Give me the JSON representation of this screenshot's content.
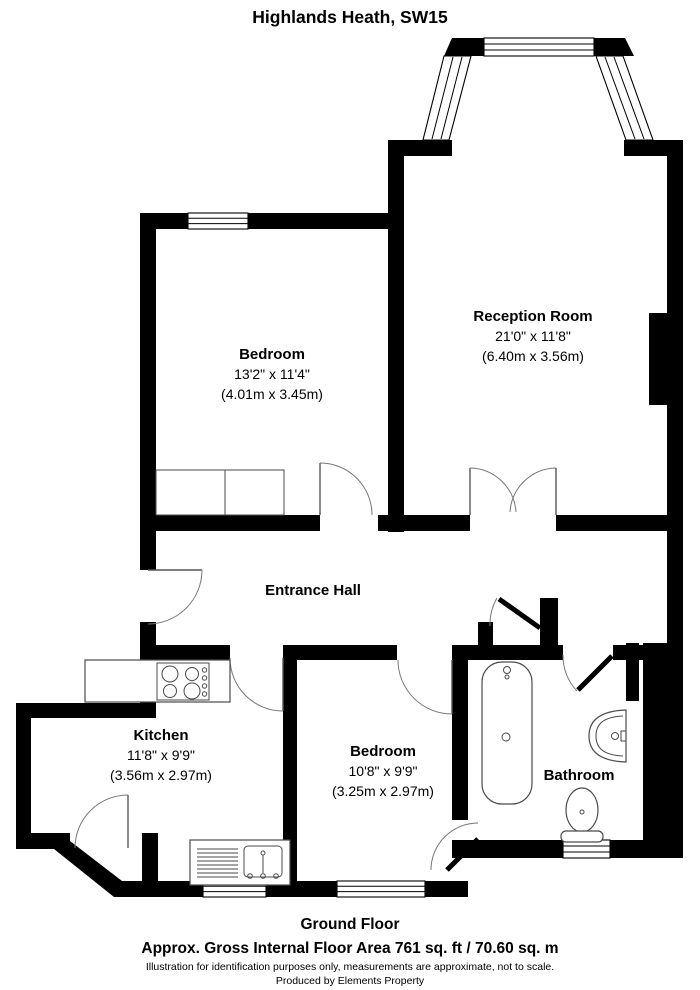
{
  "title": "Highlands Heath, SW15",
  "rooms": {
    "reception": {
      "name": "Reception Room",
      "dims_imperial": "21'0\" x 11'8\"",
      "dims_metric": "(6.40m x 3.56m)"
    },
    "bedroom1": {
      "name": "Bedroom",
      "dims_imperial": "13'2\" x 11'4\"",
      "dims_metric": "(4.01m x 3.45m)"
    },
    "entrance_hall": {
      "name": "Entrance Hall"
    },
    "kitchen": {
      "name": "Kitchen",
      "dims_imperial": "11'8\" x 9'9\"",
      "dims_metric": "(3.56m x 2.97m)"
    },
    "bedroom2": {
      "name": "Bedroom",
      "dims_imperial": "10'8\" x 9'9\"",
      "dims_metric": "(3.25m x 2.97m)"
    },
    "bathroom": {
      "name": "Bathroom"
    }
  },
  "fixtures": {
    "hob": "cooker-hob-4-rings",
    "sink": "kitchen-sink-with-drainer",
    "bath": "bathtub",
    "basin": "wash-basin",
    "toilet": "toilet"
  },
  "footer": {
    "floor_label": "Ground Floor",
    "area_line": "Approx. Gross Internal Floor Area 761 sq. ft / 70.60 sq. m",
    "disclaimer": "Illustration for identification purposes only, measurements are approximate, not to scale.",
    "produced_by": "Produced by Elements Property"
  },
  "colors": {
    "wall": "#000000",
    "background": "#ffffff"
  }
}
